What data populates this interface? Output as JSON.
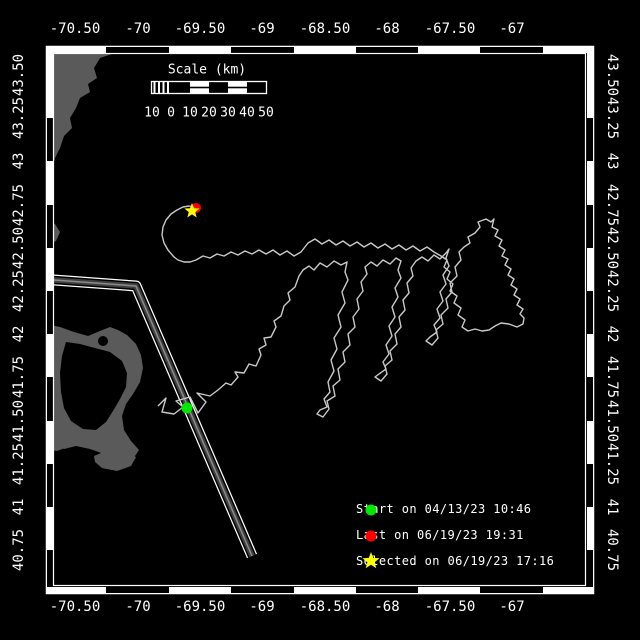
{
  "colors": {
    "background": "#000000",
    "frame": "#ffffff",
    "land": "#5a5a5a",
    "sea": "#000000",
    "track": "#c9c9c9",
    "lane_core": "#3f3f3f",
    "lane_mid": "#8c8c8c",
    "start": "#00e700",
    "last": "#ff0000",
    "selected": "#ffff00",
    "text": "#ffffff"
  },
  "axes": {
    "top": [
      {
        "x": 75,
        "t": "-70.50"
      },
      {
        "x": 138,
        "t": "-70"
      },
      {
        "x": 200,
        "t": "-69.50"
      },
      {
        "x": 262,
        "t": "-69"
      },
      {
        "x": 325,
        "t": "-68.50"
      },
      {
        "x": 387,
        "t": "-68"
      },
      {
        "x": 450,
        "t": "-67.50"
      },
      {
        "x": 512,
        "t": "-67"
      }
    ],
    "bottom": [
      {
        "x": 75,
        "t": "-70.50"
      },
      {
        "x": 138,
        "t": "-70"
      },
      {
        "x": 200,
        "t": "-69.50"
      },
      {
        "x": 262,
        "t": "-69"
      },
      {
        "x": 325,
        "t": "-68.50"
      },
      {
        "x": 387,
        "t": "-68"
      },
      {
        "x": 450,
        "t": "-67.50"
      },
      {
        "x": 512,
        "t": "-67"
      }
    ],
    "left": [
      {
        "y": 75,
        "t": "43.50"
      },
      {
        "y": 118,
        "t": "43.25"
      },
      {
        "y": 161,
        "t": "43"
      },
      {
        "y": 205,
        "t": "42.75"
      },
      {
        "y": 248,
        "t": "42.50"
      },
      {
        "y": 291,
        "t": "42.25"
      },
      {
        "y": 334,
        "t": "42"
      },
      {
        "y": 377,
        "t": "41.75"
      },
      {
        "y": 421,
        "t": "41.50"
      },
      {
        "y": 464,
        "t": "41.25"
      },
      {
        "y": 507,
        "t": "41"
      },
      {
        "y": 550,
        "t": "40.75"
      }
    ],
    "right": [
      {
        "y": 75,
        "t": "43.50"
      },
      {
        "y": 118,
        "t": "43.25"
      },
      {
        "y": 161,
        "t": "43"
      },
      {
        "y": 205,
        "t": "42.75"
      },
      {
        "y": 248,
        "t": "42.50"
      },
      {
        "y": 291,
        "t": "42.25"
      },
      {
        "y": 334,
        "t": "42"
      },
      {
        "y": 377,
        "t": "41.75"
      },
      {
        "y": 421,
        "t": "41.50"
      },
      {
        "y": 464,
        "t": "41.25"
      },
      {
        "y": 507,
        "t": "41"
      },
      {
        "y": 550,
        "t": "40.75"
      }
    ]
  },
  "scalebar": {
    "title": "Scale (km)",
    "labels": [
      {
        "x": 152,
        "t": "10"
      },
      {
        "x": 171,
        "t": "0"
      },
      {
        "x": 190,
        "t": "10"
      },
      {
        "x": 209,
        "t": "20"
      },
      {
        "x": 228,
        "t": "30"
      },
      {
        "x": 247,
        "t": "40"
      },
      {
        "x": 266,
        "t": "50"
      }
    ]
  },
  "legend": {
    "items": [
      {
        "marker": "circle",
        "color": "#00e700",
        "label": "Start on 04/13/23 10:46"
      },
      {
        "marker": "circle",
        "color": "#ff0000",
        "label": "Last on 06/19/23 19:31"
      },
      {
        "marker": "star",
        "color": "#ffff00",
        "label": "Selected on 06/19/23 17:16"
      }
    ],
    "star_points": "371,552 373.2,557.9 379.6,558.2 374.6,562.2 376.3,568.3 371,564.8 365.7,568.3 367.4,562.2 362.4,558.2 368.8,557.9"
  },
  "markers": {
    "start": {
      "x": 187,
      "y": 408
    },
    "last": {
      "x": 196,
      "y": 208
    },
    "selected_points": "192,203 194,208.3 199.6,208.5 195.2,212.1 196.7,217.5 192,214.4 187.3,217.5 188.8,212.1 184.4,208.5 190,208.3"
  },
  "map": {
    "lane_points": "40,279 136,286 252,556",
    "track_points": "158,406 166,398 162,412 174,414 183,407 176,401 190,397 198,413 206,402 197,393 210,396 218,390 226,383 231,385 238,377 235,372 244,373 249,364 256,366 261,355 259,349 266,345 264,338 271,337 276,327 274,321 281,316 284,306 290,300 288,293 295,287 299,276 303,270 309,266 314,270 320,263 327,267 334,261 341,265 347,262 345,272 348,280 342,292 345,303 338,315 341,327 334,338 337,349 331,360 334,371 328,382 330,392 324,399 327,407 320,410 317,414 323,417 329,409 327,401 335,396 333,386 340,380 338,369 345,362 343,352 350,345 348,334 355,327 353,317 359,309 357,299 363,291 361,282 367,274 365,267 371,262 377,266 383,260 390,264 396,258 401,261 398,270 401,278 395,288 398,297 392,307 395,317 389,326 392,336 386,345 389,354 383,362 386,369 379,374 375,377 381,381 387,374 385,366 392,360 390,351 397,344 395,334 401,327 399,317 405,310 403,300 409,293 407,283 413,276 411,268 416,261 422,257 428,261 434,255 440,259 446,253 449,249 446,258 449,266 443,275 446,284 440,292 443,301 437,309 440,318 434,325 437,332 430,337 426,341 432,345 438,338 436,330 443,324 441,315 448,308 446,299 452,292 450,283 457,276 455,267 461,260 459,252 464,247 470,243 468,237 475,233 480,227 478,222 486,219 491,222 494,219 492,227 498,230 495,236 502,240 499,246 505,250 502,256 508,259 505,265 511,269 508,275 514,279 511,285 517,289 514,295 520,299 517,305 523,309 520,314 524,318 523,324 517,327 509,324 501,323 495,326 489,330 482,331 475,329 468,331 462,327 465,320 458,315 461,308 454,303 457,296 450,291 453,284 447,279 450,272 444,267 447,260 441,256 434,252 427,247 420,251 413,246 406,250 399,245 392,249 385,244 378,248 371,243 364,247 357,242 350,246 343,241 336,245 329,240 322,244 315,239 308,243 301,252 294,256 287,251 280,255 273,250 266,254 259,250 252,254 245,251 238,255 231,252 224,256 217,254 210,258 203,256 196,260 190,262 184,262 178,260 174,257 168,250 164,243 162,235 163,227 166,220 171,214 177,210 183,207 189,206 194,207",
    "land": {
      "coast_ne": "46,46 118,46 112,54 100,58 94,68 97,78 88,84 90,92 80,98 76,108 70,118 72,128 64,136 60,148 55,158 52,172 50,186 46,196",
      "patch": "46,220 55,224 60,232 56,241 48,244 46,244",
      "cape": "46,324 60,327 74,332 88,336 100,331 110,327 118,330 127,335 136,344 141,355 143,368 140,382 133,394 126,404 122,416 124,430 131,441 139,450 133,459 120,459 104,454 90,449 76,446 64,449 54,444 46,440",
      "bay": "66,342 80,344 95,348 110,352 122,361 127,373 126,387 120,399 113,411 106,422 96,430 83,429 71,421 64,408 61,392 60,373 62,356",
      "marthas": "46,426 58,423 70,428 77,436 70,446 57,451 46,449",
      "nantucket": "94,456 108,450 122,451 136,457 131,466 117,471 102,468 95,462"
    }
  }
}
